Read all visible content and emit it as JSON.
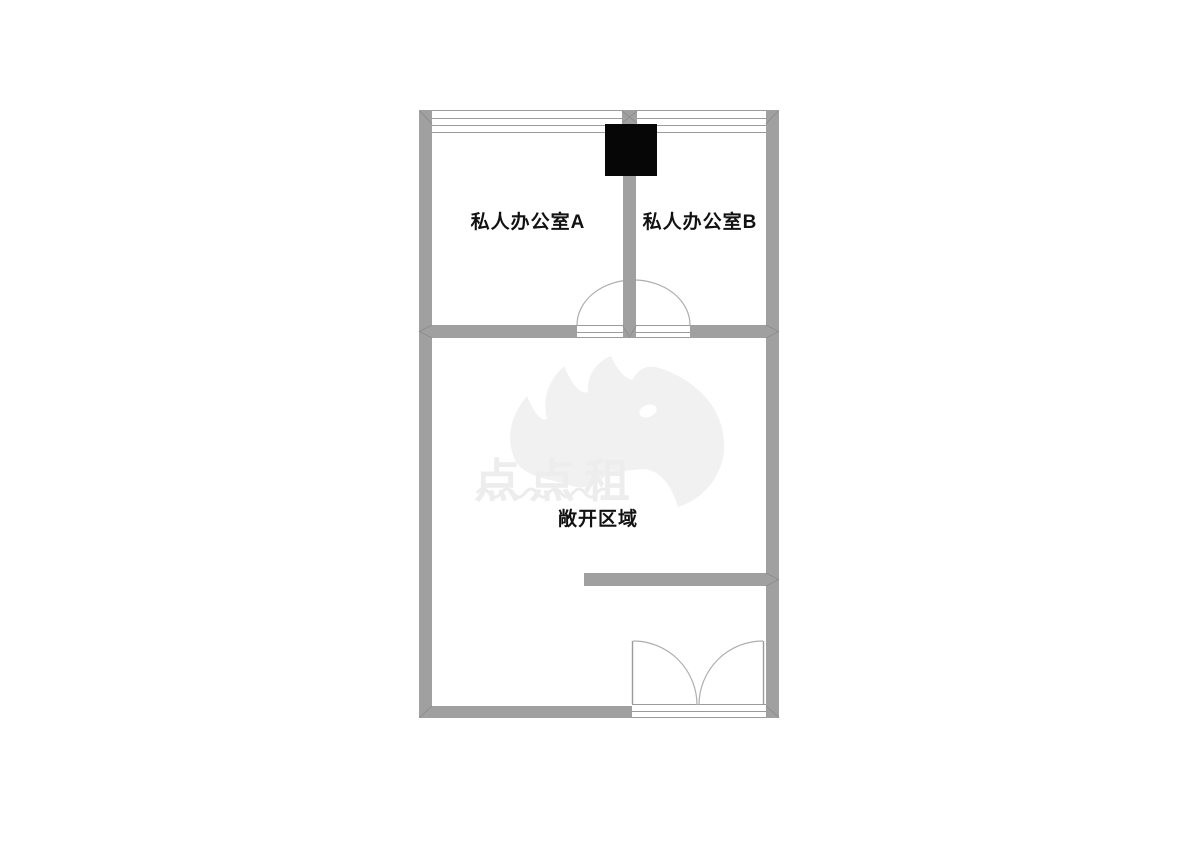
{
  "floorplan": {
    "rooms": [
      {
        "id": "office-a",
        "label": "私人办公室A"
      },
      {
        "id": "office-b",
        "label": "私人办公室B"
      },
      {
        "id": "open-area",
        "label": "敞开区域"
      }
    ],
    "icons": [
      "window-symbol",
      "door-swing-arc",
      "double-door-symbol",
      "column-block"
    ],
    "colors": {
      "wall": "#a0a0a0",
      "thin_line": "#9b9b9b",
      "door_arc": "#aeaeae",
      "column": "#060606",
      "label_text": "#121212"
    }
  },
  "watermark": {
    "text": "点点租",
    "logo": "rhino-logo",
    "color": "#ededed"
  }
}
